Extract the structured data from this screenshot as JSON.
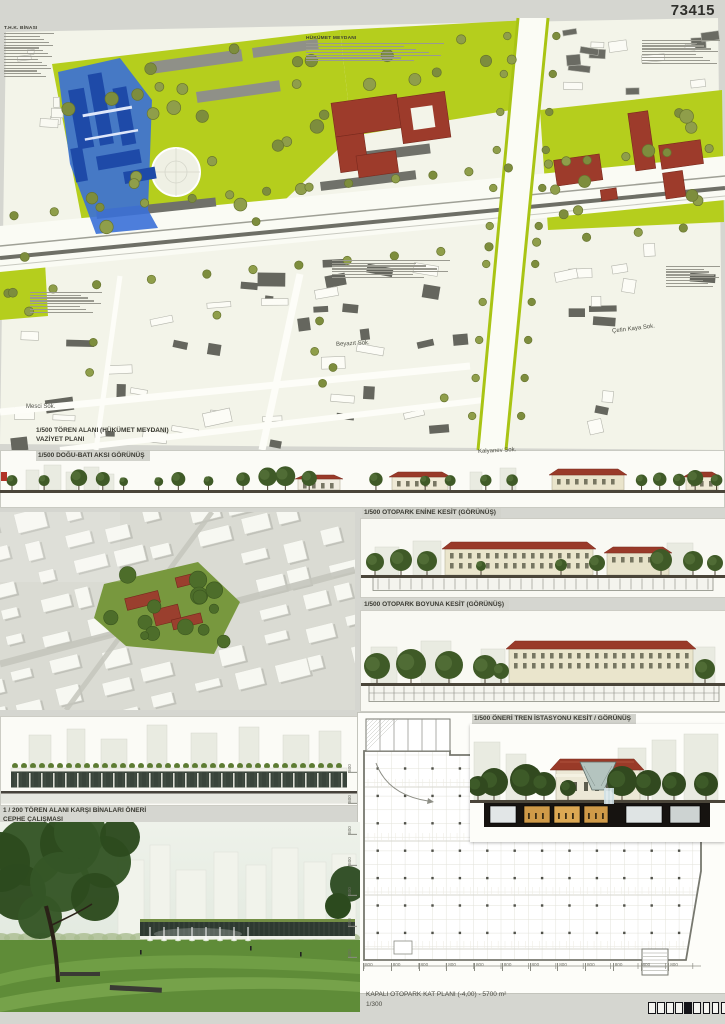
{
  "entry_number": "73415",
  "site_plan": {
    "caption_line1": "1/500 TÖREN ALANI (HÜKÜMET MEYDANI)",
    "caption_line2": "VAZİYET PLANI",
    "note_titles": {
      "thk": "T.H.K. BİNASI",
      "hukumet": "HÜKÜMET MEYDANI"
    },
    "streets": {
      "beyazit": "Beyazıt Sok.",
      "cetin_kaya": "Çetin Kaya Sok.",
      "mesci": "Mesci Sok.",
      "kalyanev": "Kalyanev Sok."
    }
  },
  "sections": {
    "dogu_bati": "1/500 DOĞU-BATI AKSI GÖRÜNÜŞ",
    "otopark_enine": "1/500 OTOPARK  ENİNE KESİT (GÖRÜNÜŞ)",
    "otopark_boyuna": "1/500 OTOPARK  BOYUNA KESİT (GÖRÜNÜŞ)",
    "tren_istasyonu": "1/500 ÖNERİ TREN İSTASYONU KESİT / GÖRÜNÜŞ",
    "cephe_line1": "1 / 200 TÖREN ALANI KARŞI BİNALARI ÖNERİ",
    "cephe_line2": "CEPHE ÇALIŞMASI"
  },
  "otopark_plan": {
    "title": "KAPALI OTOPARK KAT PLANI (-4,00) - 5700 m²",
    "scale": "1/300",
    "dim_label": "800",
    "bottom_dims": 12,
    "left_dims": 7
  },
  "pagination": {
    "squares": 10,
    "filled_index": 4
  },
  "colors": {
    "accent_green": "#b5ce1d",
    "accent_blue": "#3a6fd6",
    "roof_red": "#9c3a2c"
  }
}
